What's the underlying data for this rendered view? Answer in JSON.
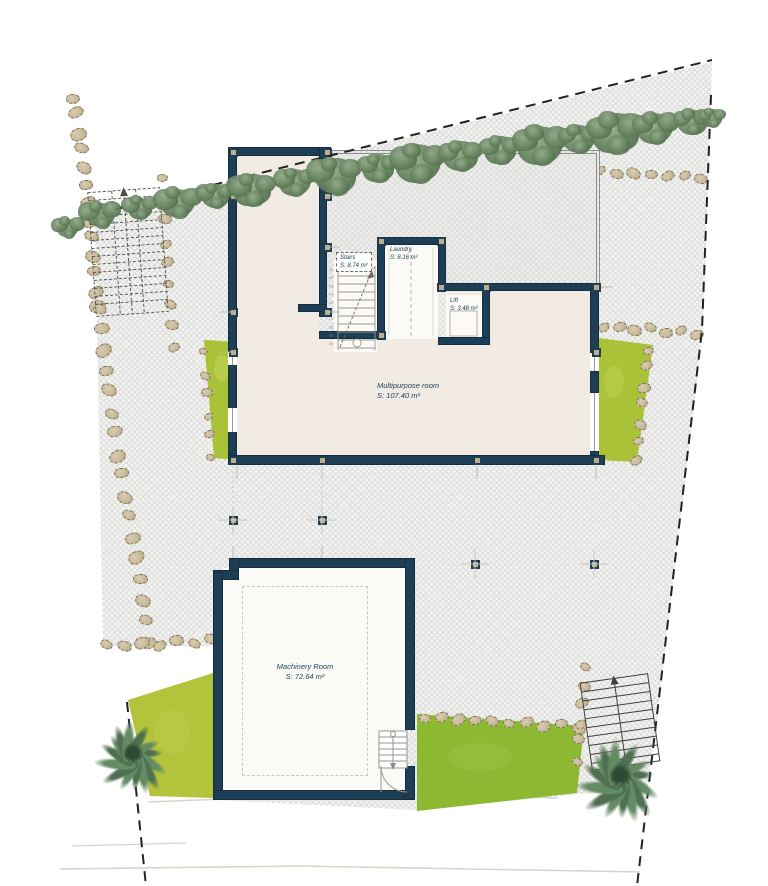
{
  "title": "Villa floor plan",
  "colors": {
    "wall": "#1d3e54",
    "wall_dark": "#132e40",
    "cream": "#f1ebe3",
    "white_floor": "#fbfaf6",
    "hatch_line": "#dcdcdb",
    "hatch_bg": "#f3f3f2",
    "terrace_bg": "#ededeb",
    "grass_side": "#a9c238",
    "grass_band": "#8cb832",
    "grass_wedge": "#b3c33c",
    "stone_fill": "#cabb9d",
    "stone_edge": "#7c7258",
    "tree_dark": "#55734f",
    "tree_light": "#93ac8b",
    "palm": "#4f6f50",
    "boundary": "#222222",
    "thin_line": "#9a958c",
    "label": "#1f4459"
  },
  "rooms": {
    "stairs": {
      "name": "Stairs",
      "area": "S: 8.74 m²"
    },
    "laundry": {
      "name": "Laundry",
      "area": "S: 8.16 m²"
    },
    "lift": {
      "name": "Lift",
      "area": "S: 3.48 m²"
    },
    "multipurpose": {
      "name": "Multipurpose room",
      "area": "S: 107.40 m²"
    },
    "machinery": {
      "name": "Machinery Room",
      "area": "S: 72.64 m²"
    }
  },
  "stair_step_numbers": [
    "11",
    "12",
    "13",
    "14",
    "15",
    "16",
    "17",
    "18",
    "19",
    "20"
  ],
  "site": {
    "trees": [
      [
        68,
        228,
        24
      ],
      [
        100,
        215,
        30
      ],
      [
        140,
        208,
        26
      ],
      [
        178,
        203,
        34
      ],
      [
        215,
        196,
        28
      ],
      [
        252,
        190,
        36
      ],
      [
        295,
        182,
        30
      ],
      [
        335,
        176,
        40
      ],
      [
        378,
        168,
        30
      ],
      [
        418,
        163,
        42
      ],
      [
        460,
        156,
        32
      ],
      [
        500,
        150,
        30
      ],
      [
        540,
        145,
        42
      ],
      [
        578,
        139,
        30
      ],
      [
        615,
        133,
        44
      ],
      [
        655,
        128,
        34
      ],
      [
        692,
        122,
        28
      ],
      [
        712,
        118,
        20
      ]
    ],
    "stone_walls": [
      {
        "x1": 73,
        "y1": 97,
        "x2": 99,
        "y2": 308,
        "n": 13,
        "s": 16
      },
      {
        "x1": 99,
        "y1": 308,
        "x2": 147,
        "y2": 642,
        "n": 17,
        "s": 16
      },
      {
        "x1": 107,
        "y1": 646,
        "x2": 209,
        "y2": 641,
        "n": 7,
        "s": 15
      },
      {
        "x1": 162,
        "y1": 180,
        "x2": 176,
        "y2": 346,
        "n": 9,
        "s": 13
      },
      {
        "x1": 601,
        "y1": 172,
        "x2": 699,
        "y2": 177,
        "n": 7,
        "s": 14
      },
      {
        "x1": 603,
        "y1": 327,
        "x2": 699,
        "y2": 333,
        "n": 7,
        "s": 14
      },
      {
        "x1": 650,
        "y1": 349,
        "x2": 634,
        "y2": 460,
        "n": 7,
        "s": 13
      },
      {
        "x1": 423,
        "y1": 717,
        "x2": 581,
        "y2": 727,
        "n": 10,
        "s": 14
      },
      {
        "x1": 588,
        "y1": 667,
        "x2": 576,
        "y2": 760,
        "n": 6,
        "s": 13
      },
      {
        "x1": 202,
        "y1": 353,
        "x2": 212,
        "y2": 456,
        "n": 6,
        "s": 11
      }
    ],
    "palms": [
      {
        "x": 133,
        "y": 753,
        "r": 40
      },
      {
        "x": 620,
        "y": 775,
        "r": 46
      }
    ],
    "columns": [
      [
        233,
        152
      ],
      [
        327,
        152
      ],
      [
        233,
        196
      ],
      [
        327,
        196
      ],
      [
        327,
        247
      ],
      [
        233,
        312
      ],
      [
        327,
        312
      ],
      [
        233,
        352
      ],
      [
        381,
        241
      ],
      [
        441,
        241
      ],
      [
        441,
        287
      ],
      [
        486,
        287
      ],
      [
        596,
        287
      ],
      [
        596,
        352
      ],
      [
        381,
        335
      ],
      [
        233,
        460
      ],
      [
        322,
        460
      ],
      [
        477,
        460
      ],
      [
        596,
        460
      ],
      [
        233,
        520
      ],
      [
        322,
        520
      ],
      [
        475,
        564
      ],
      [
        594,
        564
      ]
    ]
  }
}
